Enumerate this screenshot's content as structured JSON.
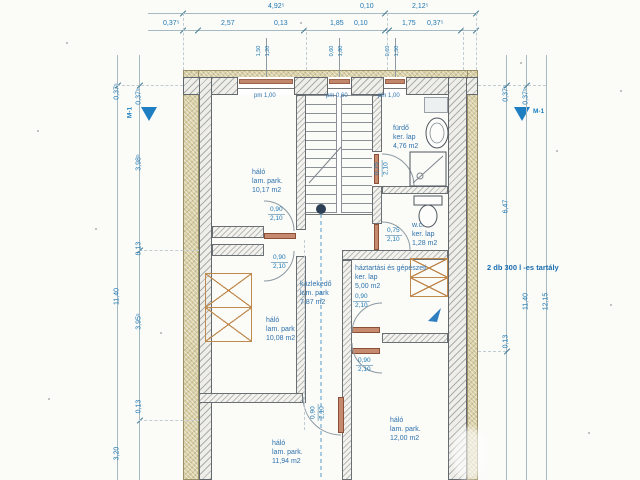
{
  "dims": {
    "top1": [
      "4,92⁵",
      "0,10",
      "2,12⁵"
    ],
    "top2": [
      "0,37⁵",
      "2,57",
      "0,13",
      "1,85",
      "0,10",
      "1,75",
      "0,37⁵"
    ],
    "leftA": [
      "0,37⁵",
      "11,40",
      "3,20"
    ],
    "leftB": [
      "0,37⁵",
      "3,98⁵",
      "0,13",
      "3,95⁵",
      "0,13"
    ],
    "rightA": [
      "0,37⁵",
      "6,47",
      "0,13"
    ],
    "rightB": [
      "0,37⁵",
      "11,40"
    ],
    "rightC": [
      "12,15"
    ],
    "marker": "M-1"
  },
  "windows": [
    {
      "w": "1,50",
      "h": "1,20",
      "pm": "pm 1,00"
    },
    {
      "w": "0,60",
      "h": "1,80",
      "pm": "pm 0,60"
    },
    {
      "w": "0,60",
      "h": "1,50",
      "pm": "pm 1,00"
    }
  ],
  "rooms": {
    "r1": {
      "name": "háló",
      "floor": "lam. park.",
      "area": "10,17 m2"
    },
    "bath": {
      "name": "fürdő",
      "floor": "ker. lap",
      "area": "4,76 m2"
    },
    "wc": {
      "name": "w.c.",
      "floor": "ker. lap",
      "area": "1,28 m2"
    },
    "util": {
      "name": "háztartási és gépészeti",
      "floor": "ker. lap",
      "area": "5,00 m2"
    },
    "corr": {
      "name": "közlekedő",
      "floor": "lam. park",
      "area": "7,87 m2"
    },
    "r2": {
      "name": "háló",
      "floor": "lam. park",
      "area": "10,08 m2"
    },
    "rbl": {
      "name": "háló",
      "floor": "lam. park.",
      "area": "11,94 m2"
    },
    "rbr": {
      "name": "háló",
      "floor": "lam. park.",
      "area": "12,00 m2"
    }
  },
  "doors": {
    "d1": {
      "w": "0,90",
      "h": "2,10"
    },
    "d2": {
      "w": "0,90",
      "h": "2,10"
    },
    "d3": {
      "w": "0,75",
      "h": "2,10"
    },
    "d4": {
      "w": "0,75",
      "h": "2,10"
    },
    "d5": {
      "w": "0,90",
      "h": "2,10"
    },
    "d6": {
      "w": "0,90",
      "h": "2,10"
    },
    "d7": {
      "w": "0,90",
      "h": "2,10"
    }
  },
  "notes": {
    "tank": "2 db 300 l -es tartály"
  },
  "colors": {
    "accent": "#1f78b2",
    "insulation": "#d8cfa5",
    "sill": "#c2876a",
    "furniture": "#c08a4e",
    "marker": "#1e7ec2"
  }
}
